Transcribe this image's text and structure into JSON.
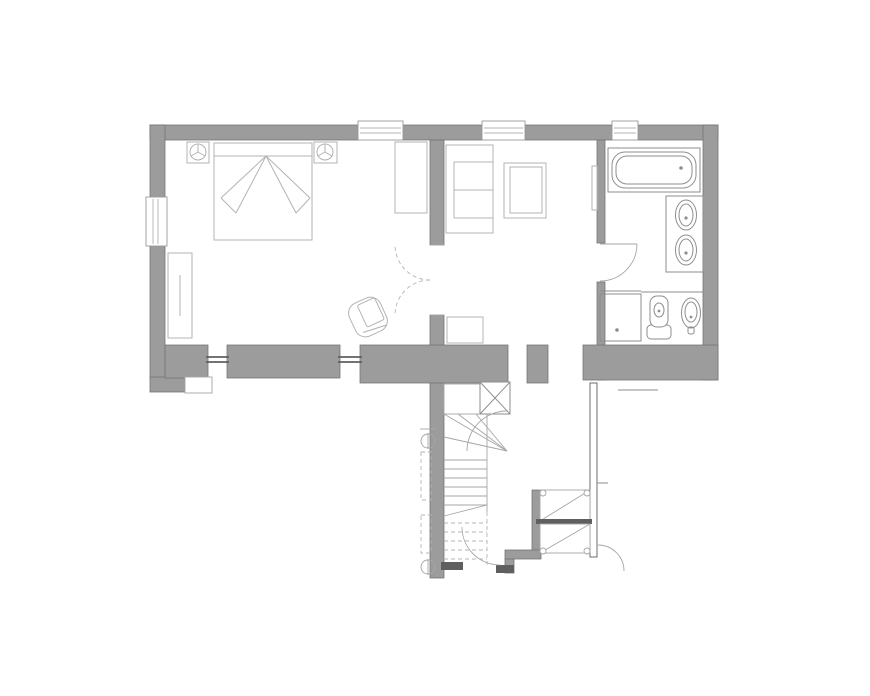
{
  "page": {
    "title": "Floor plan — upper storey",
    "background": "#ffffff"
  },
  "colors": {
    "background": "#ffffff",
    "wall_fill": "#9c9c9c",
    "wall_edge": "#757575",
    "furniture_line": "#b3b3b3",
    "fixture_line": "#8e8e8e",
    "stair_line": "#a6a6a6",
    "dashed_line": "#b5b5b5",
    "dark_accent": "#5f5f5f",
    "window_frame": "#9a9a9a"
  },
  "plan": {
    "drawing_type": "architectural floor plan, grayscale line drawing, no text labels",
    "rooms": [
      {
        "id": "bedroom",
        "label": "bedroom",
        "furniture": [
          "double bed with folded-blanket fan",
          "left nightstand with lamp",
          "right nightstand with lamp",
          "wardrobe on south wall",
          "tall cabinet on east partition",
          "tub armchair near double door"
        ],
        "windows": [
          "left wall window",
          "top wall window",
          "two south wall windows"
        ]
      },
      {
        "id": "living-room",
        "label": "living room",
        "furniture": [
          "sofa with chaise cushions",
          "square lounge chair",
          "side table on south wall",
          "radiator on east wall"
        ],
        "windows": [
          "top wall window"
        ]
      },
      {
        "id": "bathroom",
        "label": "bathroom",
        "fixtures": [
          "bathtub under window",
          "vanity counter with two oval basins",
          "shower enclosure",
          "toilet with cistern",
          "bidet"
        ],
        "windows": [
          "top wall window above bathtub"
        ]
      },
      {
        "id": "stair-hall",
        "label": "stair hall",
        "features": [
          "top landing with X shaft box",
          "winder staircase descending",
          "dashed lower flight (below cut plane)",
          "dashed under-stair cupboard with pivot circles",
          "external stepped stair with diagonal flights",
          "thin garden wall"
        ]
      }
    ],
    "doors": [
      "double door bedroom to living room (two dashed quarter arcs)",
      "bathroom door with quarter-circle swing",
      "door at stair foot",
      "garden door at lower right"
    ],
    "window_counts": {
      "top_wall": 3,
      "left_wall": 1,
      "south_wall": 2
    }
  }
}
